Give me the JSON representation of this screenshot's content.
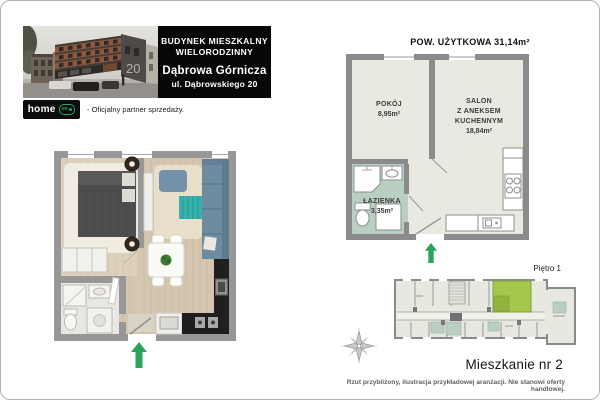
{
  "header": {
    "title_line1": "BUDYNEK MIESZKALNY",
    "title_line2": "WIELORODZINNY",
    "city": "Dąbrowa Górnicza",
    "street": "ul. Dąbrowskiego 20",
    "building_number": "20"
  },
  "logo": {
    "brand": "home",
    "badge": "on",
    "partner_text": "- Oficjalny partner sprzedaży."
  },
  "plan": {
    "area_title": "POW. UŻYTKOWA 31,14m²",
    "rooms": {
      "pokoj": {
        "name": "POKÓJ",
        "area": "8,95m²"
      },
      "salon": {
        "name": "SALON\nZ ANEKSEM\nKUCHENNYM",
        "area": "18,84m²"
      },
      "lazienka": {
        "name": "ŁAZIENKA",
        "area": "3,35m²"
      }
    }
  },
  "floor_overview": {
    "label": "Piętro 1"
  },
  "footer": {
    "apartment": "Mieszkanie nr 2",
    "disclaimer": "Rzut przybliżony, ilustracja przykładowej aranżacji. Nie stanowi oferty handlowej."
  },
  "colors": {
    "accent_green": "#2aa35c",
    "highlight_unit": "#a6c74b",
    "bathroom_fill": "#b8cfc1",
    "wall_gray": "#8b8b8b",
    "room_fill": "#eae9e1",
    "overview_room_fill": "#e7e8df"
  }
}
